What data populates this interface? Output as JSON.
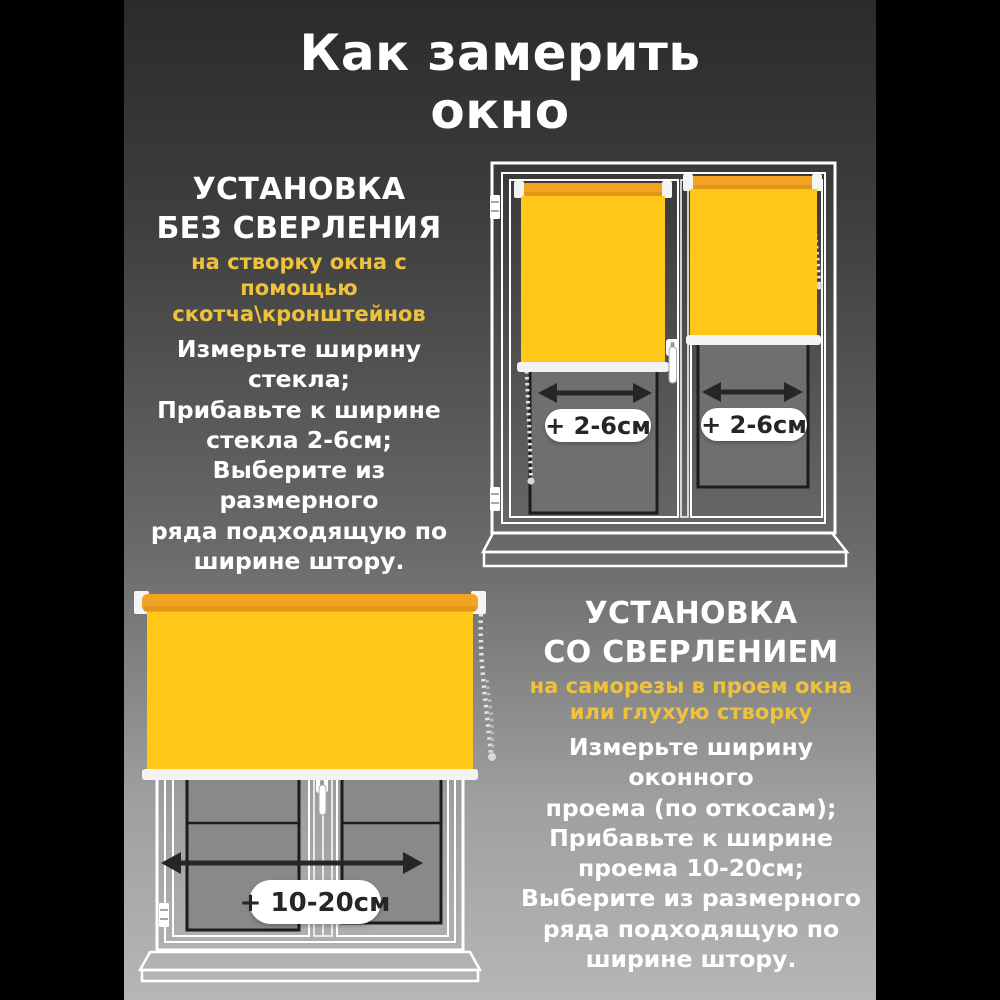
{
  "background": {
    "gradient_top": "#2B2B2B",
    "gradient_bottom": "#B6B6B6",
    "side_bars": "#000000"
  },
  "title": {
    "lines": [
      "Как замерить",
      "окно"
    ]
  },
  "sections": {
    "no_drill": {
      "heading_lines": [
        "УСТАНОВКА",
        "БЕЗ СВЕРЛЕНИЯ"
      ],
      "subtitle_lines": [
        "на створку окна с помощью",
        "скотча\\кронштейнов"
      ],
      "body_lines": [
        "Измерьте ширину",
        "стекла;",
        "Прибавьте к ширине",
        "стекла 2-6см;",
        "Выберите из",
        "размерного",
        "ряда подходящую по",
        "ширине штору."
      ]
    },
    "drill": {
      "heading_lines": [
        "УСТАНОВКА",
        "СО СВЕРЛЕНИЕМ"
      ],
      "subtitle_lines": [
        "на саморезы в проем окна",
        "или глухую створку"
      ],
      "body_lines": [
        "Измерьте ширину",
        "оконного",
        "проема (по откосам);",
        "Прибавьте к ширине",
        "проема 10-20см;",
        "Выберите из размерного",
        "ряда подходящую по",
        "ширине штору."
      ]
    }
  },
  "diagrams": {
    "sash_window": {
      "left_label": "+ 2-6см",
      "right_label": "+ 2-6см"
    },
    "opening_window": {
      "label": "+ 10-20см"
    }
  },
  "colors": {
    "accent_yellow_text": "#EEC23B",
    "blind_fabric": "#FFC717",
    "blind_tube": "#F2A322",
    "white": "#FFFFFF",
    "arrow": "#262626",
    "glass_top_window": "#6F6F6F",
    "glass_bottom_window": "#898989"
  }
}
